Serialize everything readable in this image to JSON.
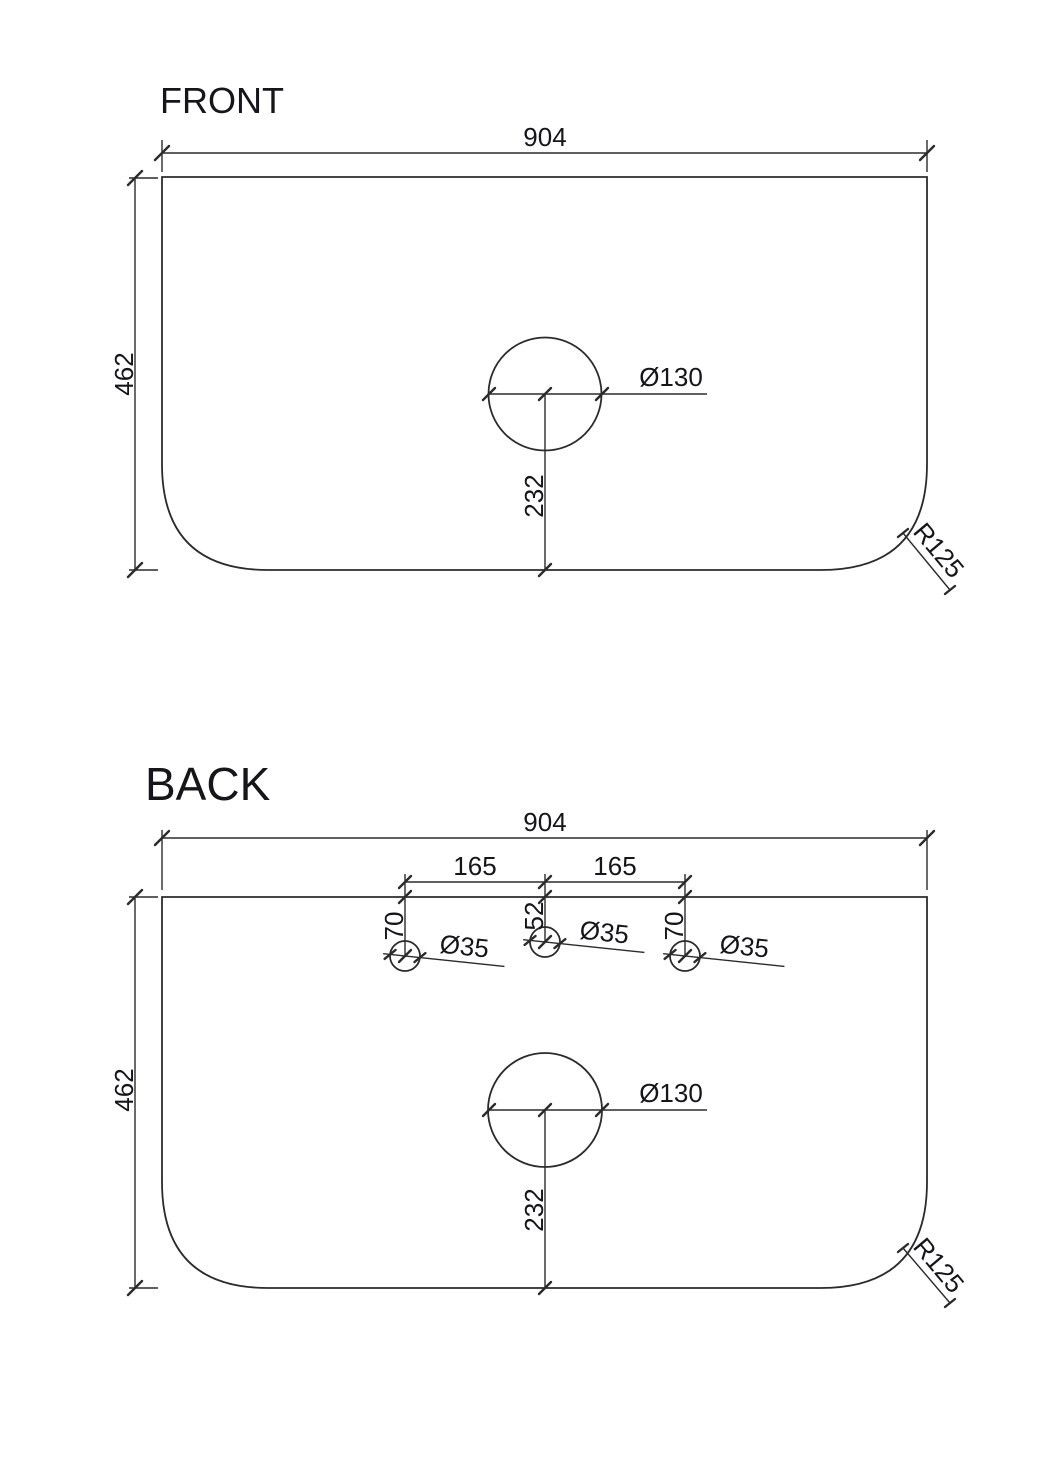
{
  "front": {
    "title": "FRONT",
    "width_dim": "904",
    "height_dim": "462",
    "hole_diameter": "Ø130",
    "hole_center_offset": "232",
    "corner_radius": "R125"
  },
  "back": {
    "title": "BACK",
    "width_dim": "904",
    "height_dim": "462",
    "tap_spacing_left": "165",
    "tap_spacing_right": "165",
    "tap_offset_left": "70",
    "tap_offset_center": "52",
    "tap_offset_right": "70",
    "tap_diameter_left": "Ø35",
    "tap_diameter_center": "Ø35",
    "tap_diameter_right": "Ø35",
    "hole_diameter": "Ø130",
    "hole_center_offset": "232",
    "corner_radius": "R125"
  },
  "colors": {
    "line": "#2b2b2b",
    "text": "#15151a",
    "background": "#ffffff"
  }
}
